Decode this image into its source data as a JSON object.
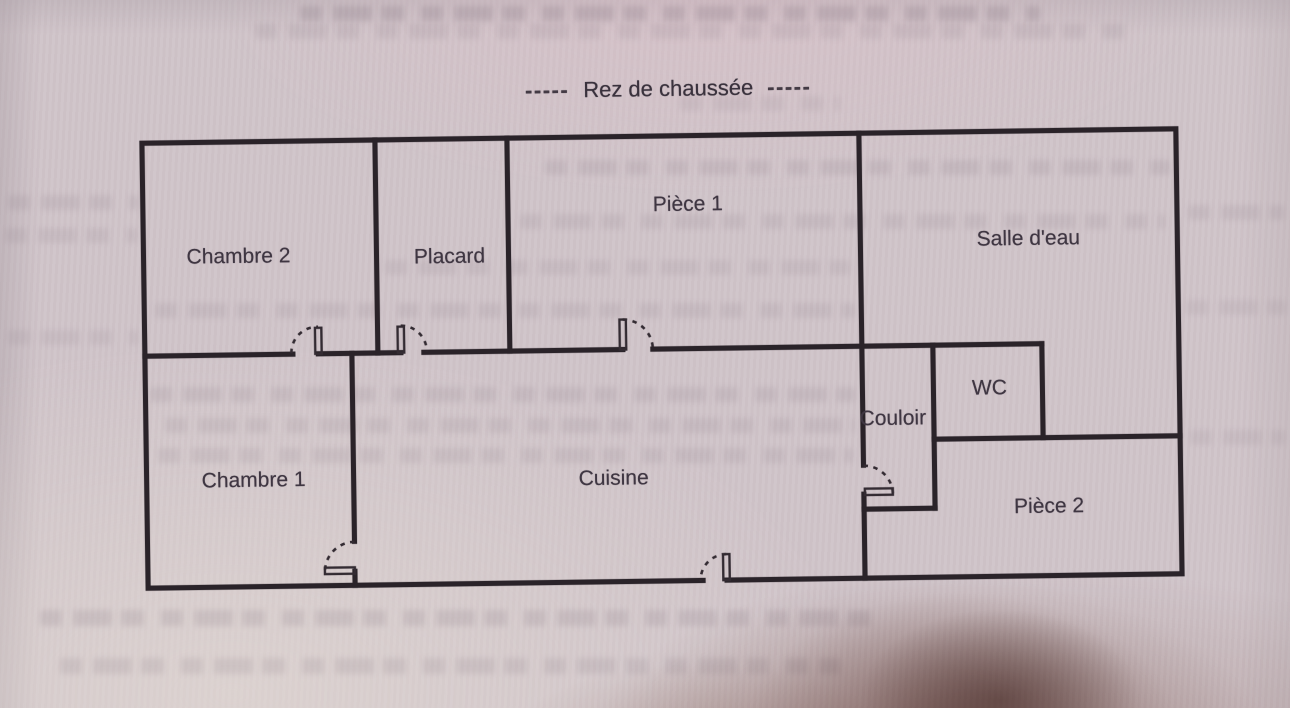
{
  "title": {
    "dash_left": "-----",
    "text": "Rez de chaussée",
    "dash_right": "-----"
  },
  "rooms": [
    {
      "name": "Chambre 2"
    },
    {
      "name": "Placard"
    },
    {
      "name": "Pièce 1"
    },
    {
      "name": "Salle d'eau"
    },
    {
      "name": "WC"
    },
    {
      "name": "Couloir"
    },
    {
      "name": "Chambre 1"
    },
    {
      "name": "Cuisine"
    },
    {
      "name": "Pièce 2"
    }
  ],
  "colors": {
    "paper": "#d0c4c9",
    "wall": "#2a2329",
    "label_text": "#3f3642",
    "shadow": "#6e4437"
  }
}
